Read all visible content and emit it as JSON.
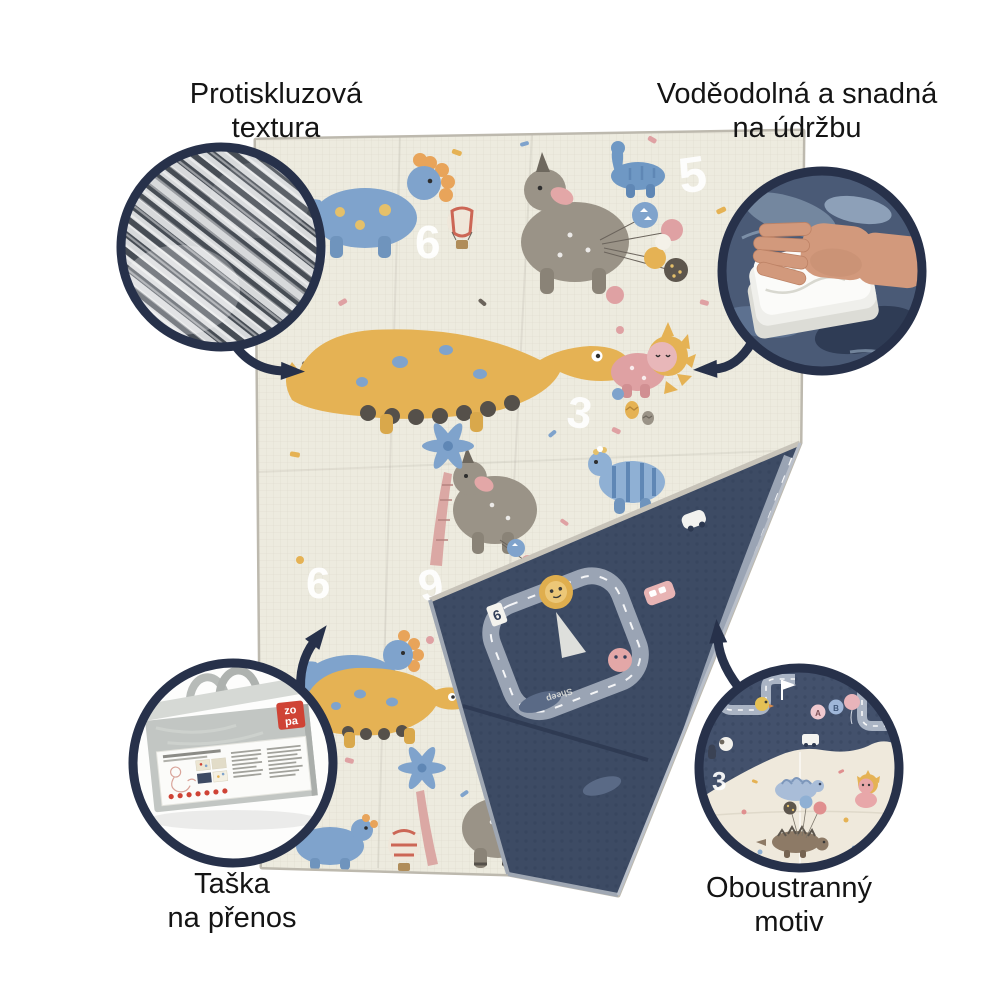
{
  "callouts": {
    "anti_slip": {
      "line1": "Protiskluzová",
      "line2": "textura"
    },
    "waterproof": {
      "line1": "Voděodolná a snadná",
      "line2": "na údržbu"
    },
    "carry_bag": {
      "line1": "Taška",
      "line2": "na přenos"
    },
    "double_sided": {
      "line1": "Oboustranný",
      "line2": "motiv"
    }
  },
  "brand": {
    "logo_line1": "zo",
    "logo_line2": "pa"
  },
  "mat": {
    "front_numbers": [
      "5",
      "6",
      "9",
      "3",
      "6",
      "9",
      "7"
    ],
    "flap_sign_number": "6",
    "flap_text": "Sheep",
    "motif_number": "3",
    "motif_balloon_letters": [
      "A",
      "B"
    ]
  },
  "colors": {
    "outline_navy": "#27314a",
    "mat_cream": "#edebdf",
    "mat_navy": "#3d4b64",
    "road_gray": "#9aa4b4",
    "edge_gray": "#bdb9ae",
    "dino_blue": "#7fa3cc",
    "dino_gray": "#9a9387",
    "dino_yellow": "#e5b254",
    "dino_pink": "#dfa1a3",
    "brand_red": "#cf4335"
  }
}
